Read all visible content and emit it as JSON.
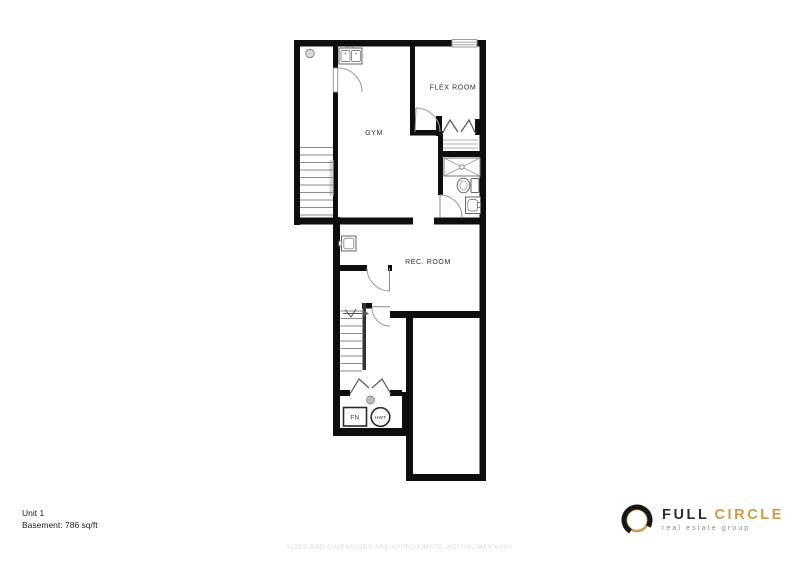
{
  "plan": {
    "unit_label": "Unit 1",
    "area_label": "Basement: 786 sq/ft",
    "rooms": [
      {
        "name": "GYM"
      },
      {
        "name": "FLEX ROOM"
      },
      {
        "name": "REC. ROOM"
      }
    ],
    "equipment": [
      {
        "label": "FN"
      },
      {
        "label": "HWT"
      }
    ],
    "fixtures": [
      "double-laundry-sink",
      "sump-circle",
      "bifold-closet-doors",
      "closet-shelves",
      "shower-stall",
      "toilet",
      "vanity-sink",
      "bar-sink",
      "stairs-up",
      "stairs-down",
      "floor-drain",
      "furnace",
      "hot-water-tank",
      "window"
    ],
    "colors": {
      "wall": "#0e0e0e",
      "fixture_line": "#777777",
      "label": "#2f2f2f"
    }
  },
  "footer": {
    "disclaimer": "SIZES AND DIMENSIONS ARE APPROXIMATE, ACTUAL MAY VARY"
  },
  "logo": {
    "name_primary": "FULL",
    "name_secondary": "CIRCLE",
    "tagline": "real estate group",
    "colors": {
      "primary": "#2d2d2d",
      "accent": "#d39a44",
      "tagline": "#8c8c8c"
    }
  }
}
